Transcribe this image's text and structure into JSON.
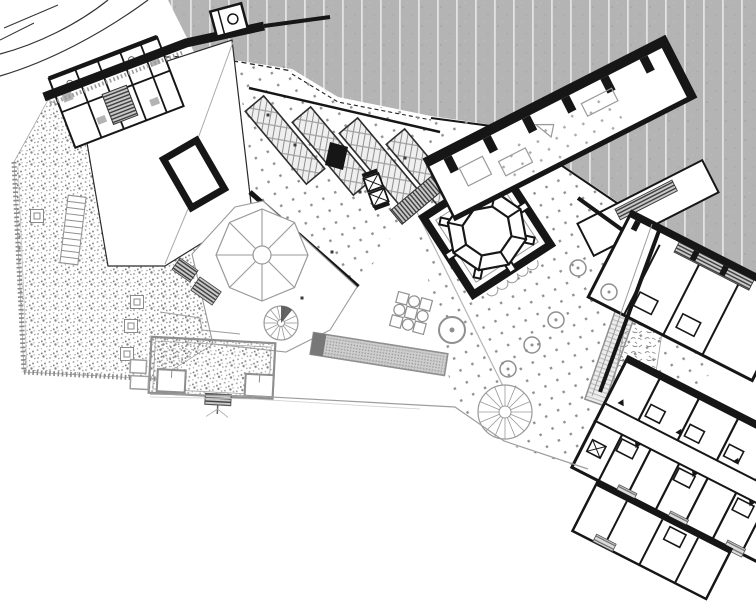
{
  "document": {
    "type": "architectural-site-plan",
    "description": "Black and white roof-level site plan of a museum complex on a slope, no text labels visible",
    "visible_text": []
  },
  "canvas": {
    "width": 756,
    "height": 606
  },
  "palette": {
    "paper": "#ffffff",
    "ink": "#161616",
    "wall_gray": "#8f8f8f",
    "light_gray": "#bdbdbd",
    "backdrop_gray": "#b4b4b4",
    "backdrop_stripe": "#e2e2e2",
    "stipple_gray": "#9a9a9a",
    "hatch_dark": "#3d3d3d",
    "water_gray": "#cecece"
  },
  "texture_legend": {
    "striped_gray": "unexcavated hillside / context field",
    "square_dots": "paved plaza",
    "stipple": "gravel garden / planted roof",
    "dense_hatch": "stairs and ramps",
    "squiggle": "planting bed",
    "glazing_grid": "skylight / glazed roof strips",
    "speckle_bar": "long water basin"
  },
  "elements": [
    {
      "name": "context-backdrop",
      "kind": "terrain"
    },
    {
      "name": "site-boundary-curves",
      "kind": "boundary"
    },
    {
      "name": "retaining-wall-band",
      "kind": "wall"
    },
    {
      "name": "nw-room-cluster",
      "kind": "building"
    },
    {
      "name": "main-hall",
      "kind": "building"
    },
    {
      "name": "roof-frame-opening",
      "kind": "skylight"
    },
    {
      "name": "skylight-strips",
      "kind": "roof-glazing"
    },
    {
      "name": "plaza-paving",
      "kind": "plaza"
    },
    {
      "name": "garden-stipple-field",
      "kind": "garden"
    },
    {
      "name": "umbrella-roof-octagon",
      "kind": "pavilion"
    },
    {
      "name": "octagon-court",
      "kind": "courtyard"
    },
    {
      "name": "buttressed-gallery-band",
      "kind": "building"
    },
    {
      "name": "access-ramp",
      "kind": "circulation"
    },
    {
      "name": "hotel-room-wing",
      "kind": "building"
    },
    {
      "name": "long-pool",
      "kind": "water"
    },
    {
      "name": "table-cluster",
      "kind": "furniture"
    },
    {
      "name": "spiral-stairs",
      "kind": "circulation"
    },
    {
      "name": "lower-gray-building",
      "kind": "building"
    }
  ],
  "features": {
    "trees": {
      "radius": 8,
      "items": [
        [
          578,
          268
        ],
        [
          609,
          292
        ],
        [
          556,
          320
        ],
        [
          532,
          345
        ],
        [
          508,
          369
        ]
      ]
    },
    "plaza_accent_dots": [
      [
        295,
        145
      ],
      [
        360,
        192
      ],
      [
        268,
        115
      ],
      [
        405,
        158
      ],
      [
        332,
        252
      ],
      [
        302,
        298
      ]
    ],
    "garden_planters": [
      [
        37,
        216
      ],
      [
        137,
        302
      ],
      [
        131,
        326
      ],
      [
        127,
        354
      ]
    ],
    "door_markers": [
      [
        -95,
        -16,
        180
      ],
      [
        -62,
        10,
        0
      ],
      [
        -30,
        -16,
        180
      ],
      [
        2,
        10,
        0
      ],
      [
        34,
        -16,
        180
      ],
      [
        66,
        10,
        0
      ],
      [
        98,
        -16,
        180
      ]
    ],
    "court": {
      "center": [
        487,
        231
      ],
      "rotation": -33,
      "buttresses": 8,
      "spoke_r0": 25,
      "spoke_r1": 40,
      "buttress_offset": 43
    },
    "umbrella": {
      "center": [
        262,
        255
      ],
      "radius": 46,
      "ribs": 8,
      "hub_radius": 9
    },
    "spiral_stairs": [
      {
        "cx": 281,
        "cy": 323,
        "r": 17,
        "hub": 3.5,
        "treads": 14
      },
      {
        "cx": 505,
        "cy": 412,
        "r": 27,
        "hub": 6,
        "treads": 16
      }
    ],
    "glazing_rows": {
      "count": 4,
      "start": [
        285,
        140
      ],
      "step": [
        47,
        11
      ],
      "length": 95,
      "width": 24,
      "angle": 50
    },
    "garden_stair": {
      "x": 73,
      "y": 230,
      "w": 18,
      "h": 68,
      "rungs": 11,
      "angle": 7
    }
  }
}
